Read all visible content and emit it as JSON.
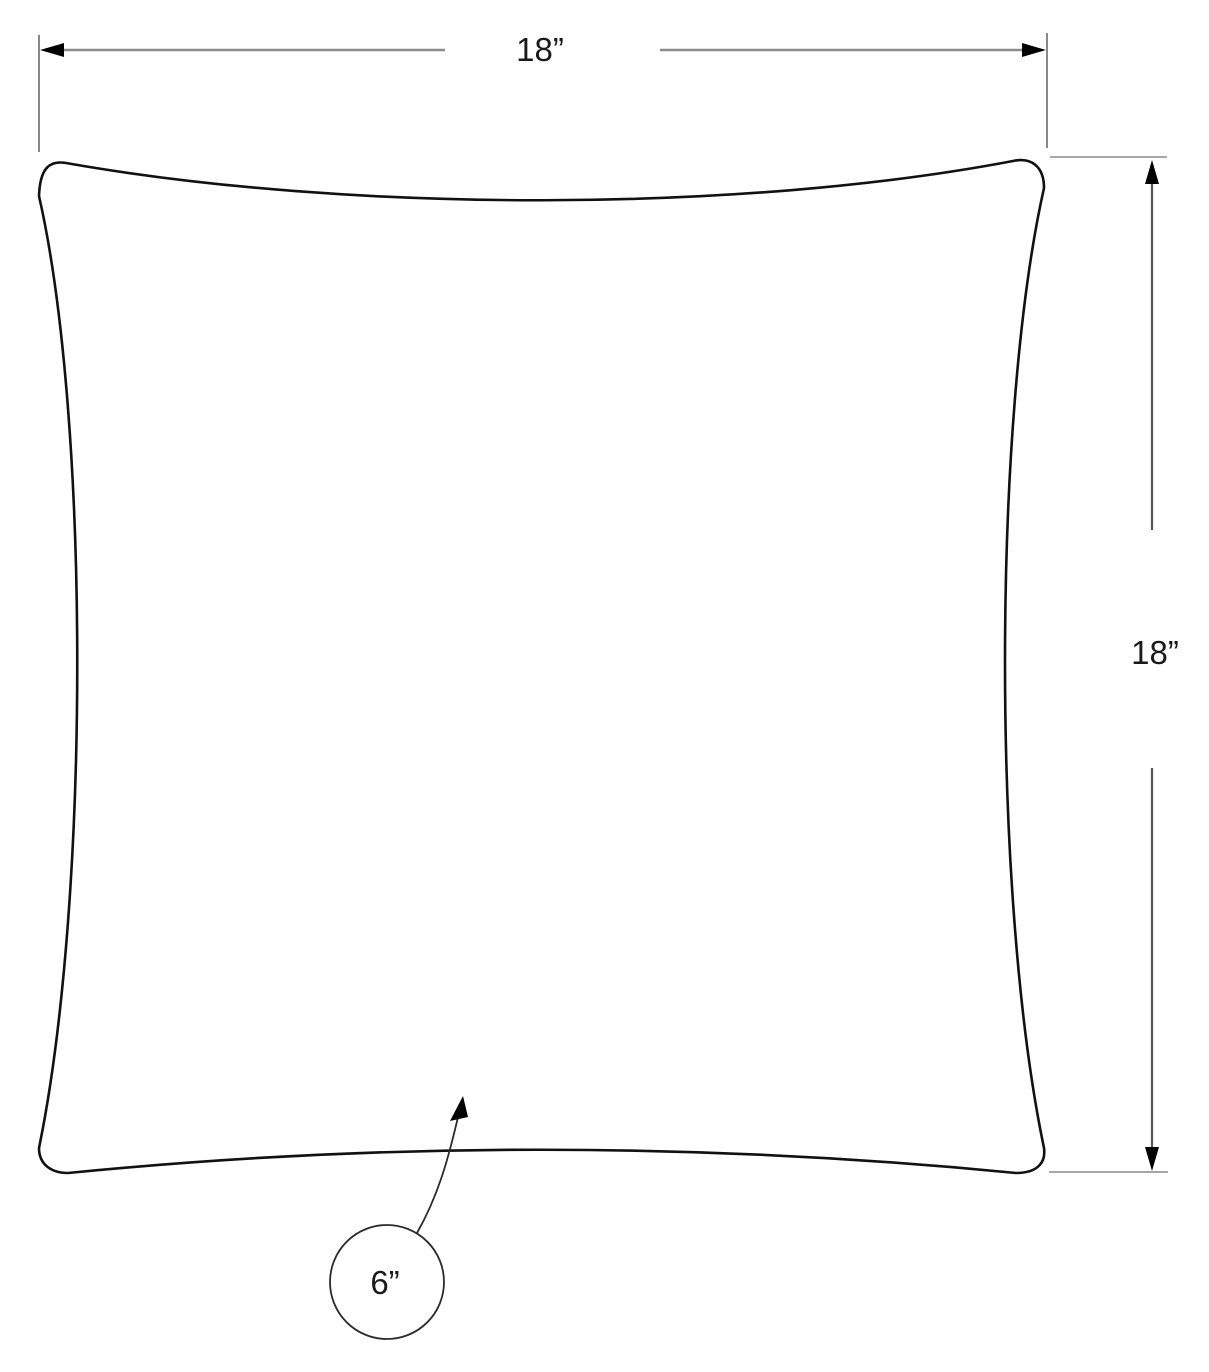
{
  "diagram": {
    "kind": "pillow-dimension-drawing",
    "width_dimension": {
      "label": "18”"
    },
    "height_dimension": {
      "label": "18”"
    },
    "callout": {
      "label": "6”"
    }
  },
  "colors": {
    "background": "#ffffff",
    "pillow_outline": "#111111",
    "dimension_line": "#8c8c8c",
    "extension_line": "#555555",
    "arrowhead": "#000000",
    "callout_stroke": "#2b2b2b",
    "label_text": "#1a1a1a"
  }
}
